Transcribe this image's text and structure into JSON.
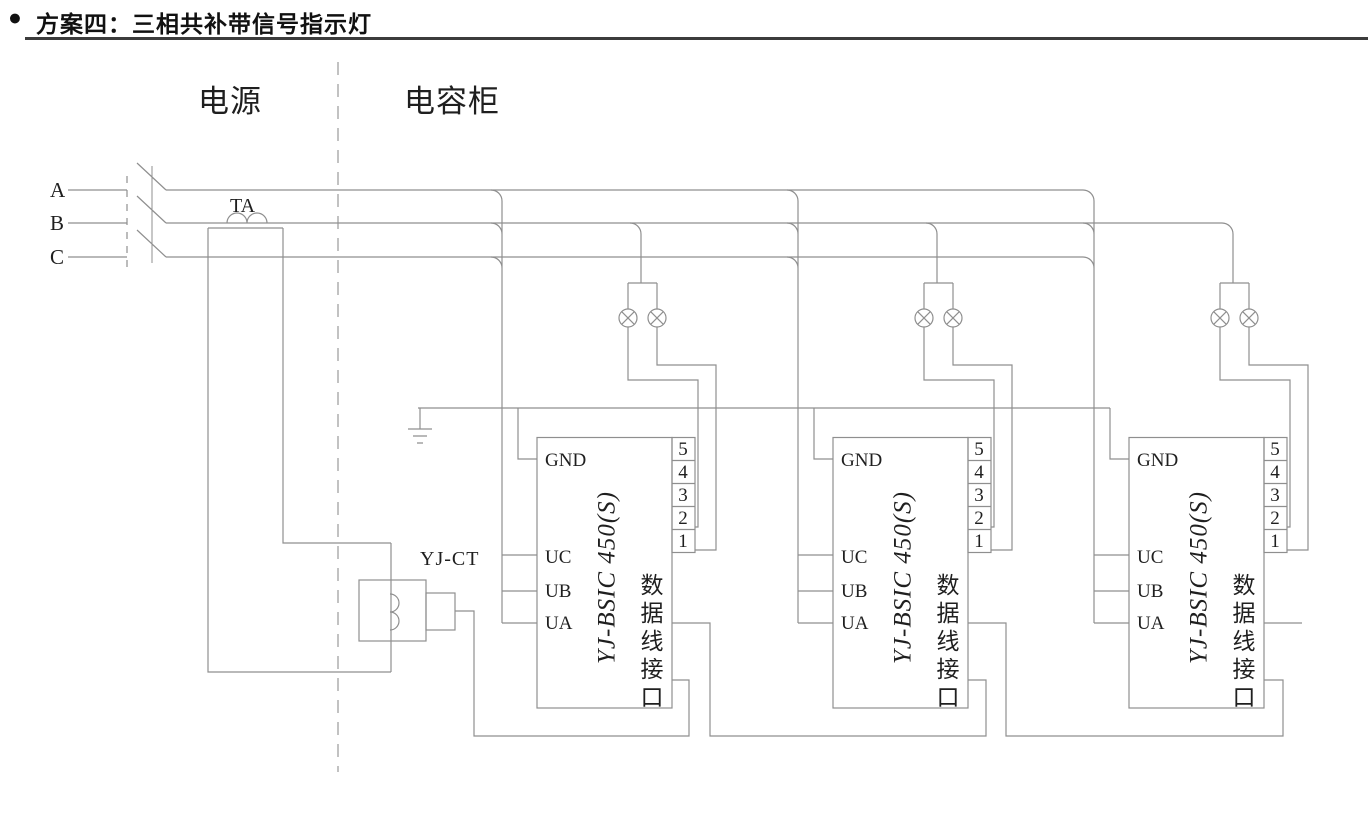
{
  "title": {
    "bullet": "●",
    "text": "方案四：三相共补带信号指示灯"
  },
  "sections": {
    "power": "电源",
    "capacitor_cabinet": "电容柜"
  },
  "phases": {
    "a": "A",
    "b": "B",
    "c": "C"
  },
  "components": {
    "ta": "TA",
    "yjct": "YJ-CT"
  },
  "module": {
    "model": "YJ-BSIC 450(S)",
    "gnd": "GND",
    "uc": "UC",
    "ub": "UB",
    "ua": "UA",
    "interface_label": "数据线接口",
    "interface_chars": [
      "数",
      "据",
      "线",
      "接",
      "口"
    ],
    "pins": [
      "5",
      "4",
      "3",
      "2",
      "1"
    ]
  },
  "colors": {
    "wire": "#8f8f8f",
    "ink": "#1f1f1f",
    "title": "#111111",
    "rule": "#3c3c3c"
  }
}
